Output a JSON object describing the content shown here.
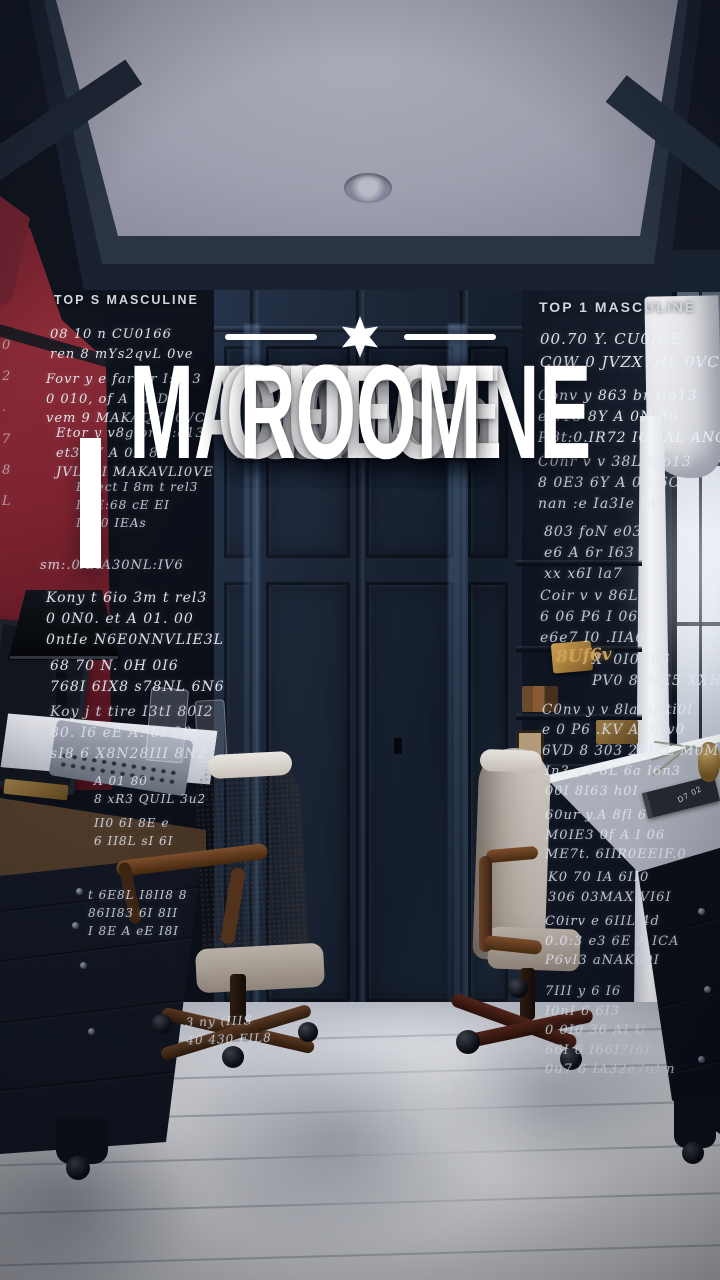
{
  "palette": {
    "navy_wall": "#16202e",
    "red_wall": "#7a2330",
    "ceiling": "#a4a5b3",
    "floor": "#e2e3e8",
    "title_text": "#ffffff",
    "amber_accent": "#c79a4c",
    "chair_fabric": "#c9c2ba",
    "wood": "#5a3a24"
  },
  "title": {
    "lines": [
      "TOP 15",
      "MASCULINE",
      "HOME",
      "OFFICE",
      "GUEST",
      "ROOM"
    ]
  },
  "decor": {
    "star_icon": "six-point-star",
    "rule_lines": 2
  },
  "wall_headers": {
    "left": "TOP S MASCULINE",
    "right": "TOP 1 MASCULINE"
  },
  "ghost": {
    "edge": [
      "0",
      "2",
      ".",
      "7",
      "8",
      "L"
    ],
    "l1": [
      "08 10 n CU0166",
      "ren 8 mYs2qvL 0ve"
    ],
    "l2": [
      "Fovr y e far tir I:o13",
      "0 010, of A 01 D0",
      "vem 9 MAKAQVU0VC"
    ],
    "l3": [
      "Etor y v8giori t:o13",
      "et3 eY A 0E 8C",
      "JVL. 6I MAKAVLI0VE"
    ],
    "l4": [
      "Effect I 8m t rel3",
      "I 8E:68 cE EI",
      "II0 0 IEAs"
    ],
    "l5": [
      "sm:.0AAA30NL:IV6"
    ],
    "l6": [
      "Kony t 6io 3m t rel3",
      "0 0N0. et A 01. 00",
      "0ntIe N6E0NNVLIE3L"
    ],
    "l7": [
      "68 70 N. 0H 0I6",
      "768I 6IX8 s78NL 6N6"
    ],
    "l8": [
      "Koy j t tire I3tI 80I2",
      "80. I6 eE A. 0I 80",
      "sI8 6 X8N28III 8N2"
    ],
    "c1": [
      "A 01 80",
      "8 xR3 QUIL 3u2"
    ],
    "c2": [
      "II0 6I 8E e",
      "6 II8L sI 6I"
    ],
    "c3": [
      "t 6E8L I8II8 8",
      "86II83 6I 8II",
      "I 8E A eE I8I"
    ],
    "f1": [
      "3 ny (IIIS",
      "40 430 FIL8"
    ],
    "r1": [
      "00.70 Y. CU0IGE",
      "C0W 0 JVZX7HL 0VC"
    ],
    "r2": [
      "Conv y 863 br tio13",
      "e 018 8Y A 0N 86",
      "P.8t:0.IR72 IGNAL ANC"
    ],
    "r3": [
      "C0nr v v 38L bio13",
      "8 0E3 6Y A 0E 6C",
      "nan :e Ia3Ie Lv"
    ],
    "r4": [
      "803 foN e03",
      "e6 A 6r I63",
      "xx x6I la7"
    ],
    "r5": [
      "Coir v v 86L",
      "6 06 P6 I 06",
      "e6e7 I0 .IIA6"
    ],
    "r6": [
      "X' 0I0 :86",
      "PV0 8 3IE5 XXHU0VE"
    ],
    "r7": [
      "C0nv y v 8la br ti0l",
      "e 0 P6 .KV A 0r v0",
      "6VD 8 303 20JAL M0M"
    ],
    "r8": [
      "In3 y I 8L 6a I6n3",
      "00I 8I63 h0I"
    ],
    "r9": [
      "60ur y.A 8fl 6",
      "M0IE3 0f A I 06",
      "ME7t. 6IIR0EEIF.0"
    ],
    "r10": [
      "K0 70 IA 6II0",
      "306 03MAX VI6I"
    ],
    "r11": [
      "C0irv e 6IIL 4d",
      "0.0:3 e3 6E A ICA",
      "P6vI3 aNAK00I"
    ],
    "r12": [
      "7III y 6 I6",
      "I0nI 6 6I3",
      "0 0I0 36 AI U",
      "66I 6 I66I7I6I",
      "0u7 6 IA32e7uI n"
    ],
    "amber_word": "8Uf6v",
    "book_label": "D7 02"
  }
}
